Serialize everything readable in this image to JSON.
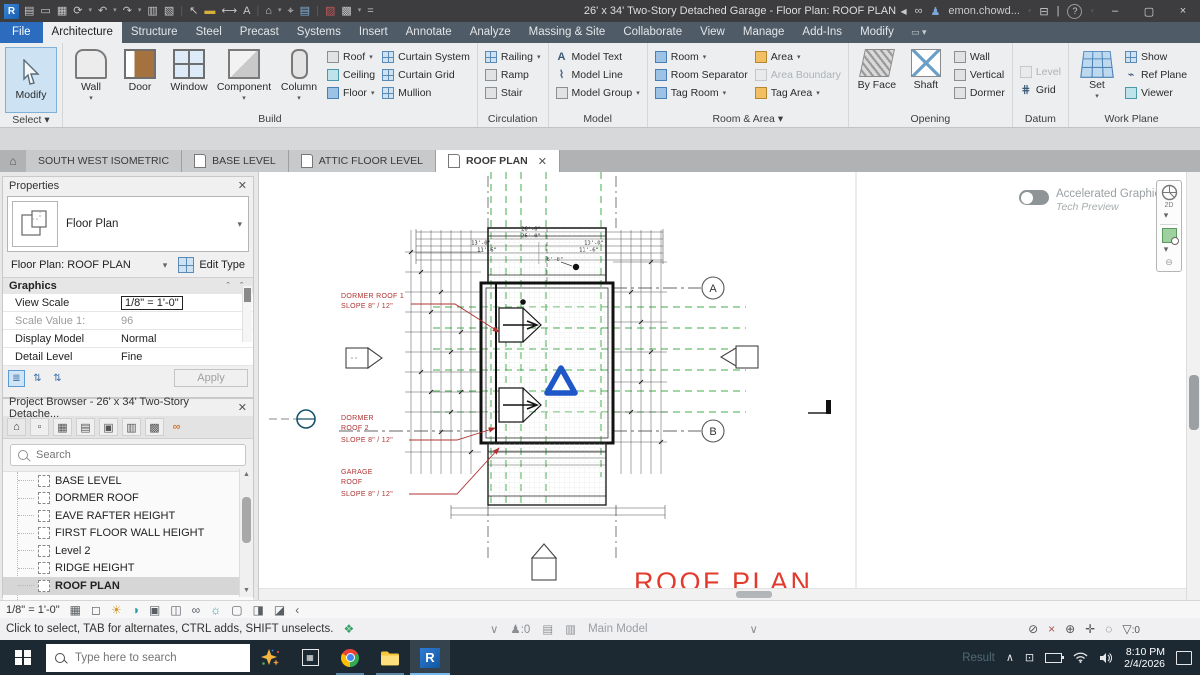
{
  "titlebar": {
    "title": "26' x 34' Two-Story Detached Garage - Floor Plan: ROOF PLAN",
    "user": "emon.chowd..."
  },
  "tabs": {
    "file": "File",
    "items": [
      "Architecture",
      "Structure",
      "Steel",
      "Precast",
      "Systems",
      "Insert",
      "Annotate",
      "Analyze",
      "Massing & Site",
      "Collaborate",
      "View",
      "Manage",
      "Add-Ins",
      "Modify"
    ]
  },
  "ribbon": {
    "select": {
      "modify": "Modify",
      "caption": "Select"
    },
    "build": {
      "caption": "Build",
      "wall": "Wall",
      "door": "Door",
      "window": "Window",
      "component": "Component",
      "column": "Column",
      "roof": "Roof",
      "ceiling": "Ceiling",
      "floor": "Floor",
      "curtain_system": "Curtain System",
      "curtain_grid": "Curtain Grid",
      "mullion": "Mullion"
    },
    "circulation": {
      "caption": "Circulation",
      "railing": "Railing",
      "ramp": "Ramp",
      "stair": "Stair"
    },
    "model": {
      "caption": "Model",
      "text": "Model Text",
      "line": "Model Line",
      "group": "Model Group"
    },
    "room_area": {
      "caption": "Room & Area",
      "room": "Room",
      "separator": "Room Separator",
      "tag_room": "Tag Room",
      "area": "Area",
      "area_boundary": "Area Boundary",
      "tag_area": "Tag Area"
    },
    "opening": {
      "caption": "Opening",
      "by_face": "By Face",
      "shaft": "Shaft",
      "wall": "Wall",
      "vertical": "Vertical",
      "dormer": "Dormer"
    },
    "datum": {
      "caption": "Datum",
      "level": "Level",
      "grid": "Grid"
    },
    "work_plane": {
      "caption": "Work Plane",
      "set": "Set",
      "show": "Show",
      "ref_plane": "Ref Plane",
      "viewer": "Viewer"
    }
  },
  "view_tabs": [
    "SOUTH WEST ISOMETRIC",
    "BASE LEVEL",
    "ATTIC FLOOR LEVEL",
    "ROOF PLAN"
  ],
  "properties": {
    "header": "Properties",
    "type_name": "Floor Plan",
    "instance": "Floor Plan: ROOF PLAN",
    "edit_type": "Edit Type",
    "section": "Graphics",
    "rows": [
      {
        "label": "View Scale",
        "value": "1/8\" = 1'-0\""
      },
      {
        "label": "Scale Value    1:",
        "value": "96"
      },
      {
        "label": "Display Model",
        "value": "Normal"
      },
      {
        "label": "Detail Level",
        "value": "Fine"
      }
    ],
    "apply": "Apply"
  },
  "browser": {
    "header": "Project Browser - 26' x 34' Two-Story Detache...",
    "search_placeholder": "Search",
    "items": [
      "BASE LEVEL",
      "DORMER ROOF",
      "EAVE RAFTER HEIGHT",
      "FIRST FLOOR WALL HEIGHT",
      "Level 2",
      "RIDGE HEIGHT",
      "ROOF PLAN"
    ]
  },
  "canvas": {
    "annotations": {
      "dormer1": [
        "DORMER  ROOF 1",
        "SLOPE 8\" / 12\""
      ],
      "dormer2": [
        "DORMER",
        "ROOF 2",
        "SLOPE 8\" / 12\""
      ],
      "garage": [
        "GARAGE",
        "ROOF",
        "SLOPE 8\" / 12\""
      ],
      "title": "ROOF PLAN"
    },
    "grid_bubbles": [
      "A",
      "B"
    ],
    "dims": [
      "26'-0\"",
      "26'-0\"",
      "13'-0\"",
      "13'-0\"",
      "11'-6\"",
      "11'-6\"",
      "6'-0\""
    ],
    "accel": {
      "line1": "Accelerated Graphics",
      "line2": "Tech Preview"
    },
    "nav_2d": "2D"
  },
  "view_bar": {
    "scale": "1/8\" = 1'-0\""
  },
  "status": {
    "hint": "Click to select, TAB for alternates, CTRL adds, SHIFT unselects.",
    "main_model": "Main Model",
    "editable_count": ":0",
    "filter_count": ":0"
  },
  "taskbar": {
    "search_placeholder": "Type here to search",
    "tray_text": "Result",
    "time": "8:10 PM",
    "date": "2/4/2026"
  }
}
